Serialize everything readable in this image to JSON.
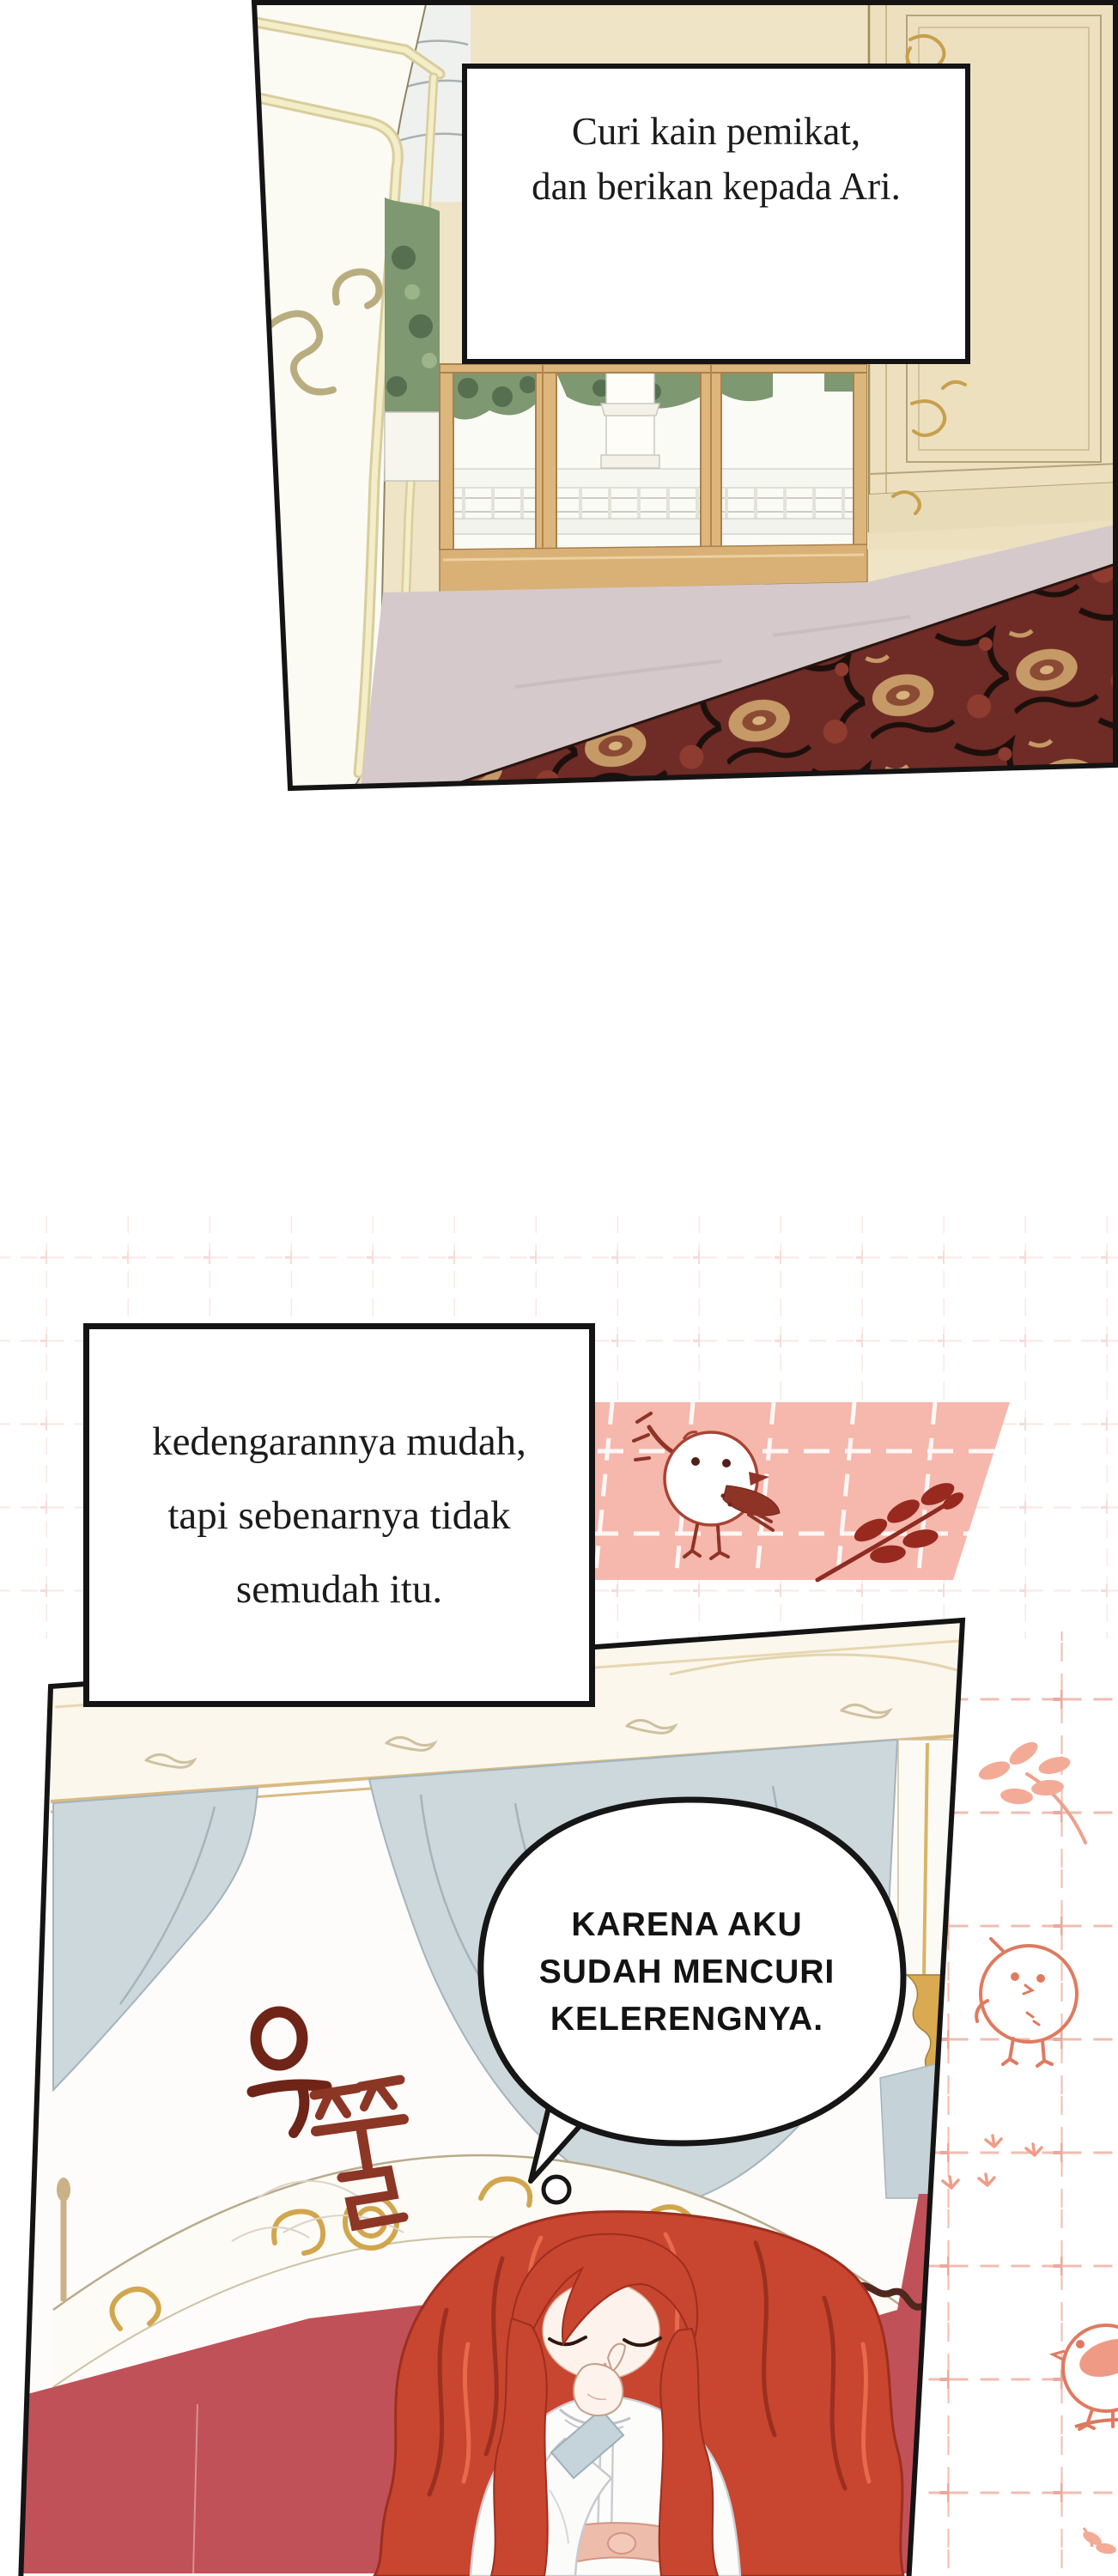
{
  "captions": {
    "top": {
      "lines": [
        "Curi kain pemikat,",
        "dan berikan kepada Ari."
      ]
    },
    "middle": {
      "lines": [
        "kedengarannya mudah,",
        "tapi sebenarnya tidak",
        "semudah itu."
      ]
    }
  },
  "thought_bubble": {
    "lines": [
      "KARENA AKU",
      "SUDAH MENCURI",
      "KELERENGNYA."
    ]
  },
  "sfx": {
    "text": "우쭐",
    "color": "#7d2b1e"
  },
  "colors": {
    "ink": "#141414",
    "wall_cream": "#efe4c6",
    "window_wood": "#ddb67c",
    "foliage_green": "#7e9872",
    "carpet_maroon": "#6f2b25",
    "carpet_gold": "#c59a67",
    "floor_grey": "#d5c9cb",
    "washi_band_pink": "#f6b7ac",
    "deco_dark_red": "#8e3426",
    "deco_pink": "#e0785f",
    "grid_pink": "#f2bdb2",
    "curtain_blue": "#cdd8dc",
    "valance_cream": "#fbf7ec",
    "headboard_gold": "#d2a64e",
    "bedding_red": "#c15159",
    "hair_red": "#c8452f",
    "skin": "#fdf3ec",
    "gown_white": "#fcfcfb",
    "sash_pink": "#eebcab"
  }
}
